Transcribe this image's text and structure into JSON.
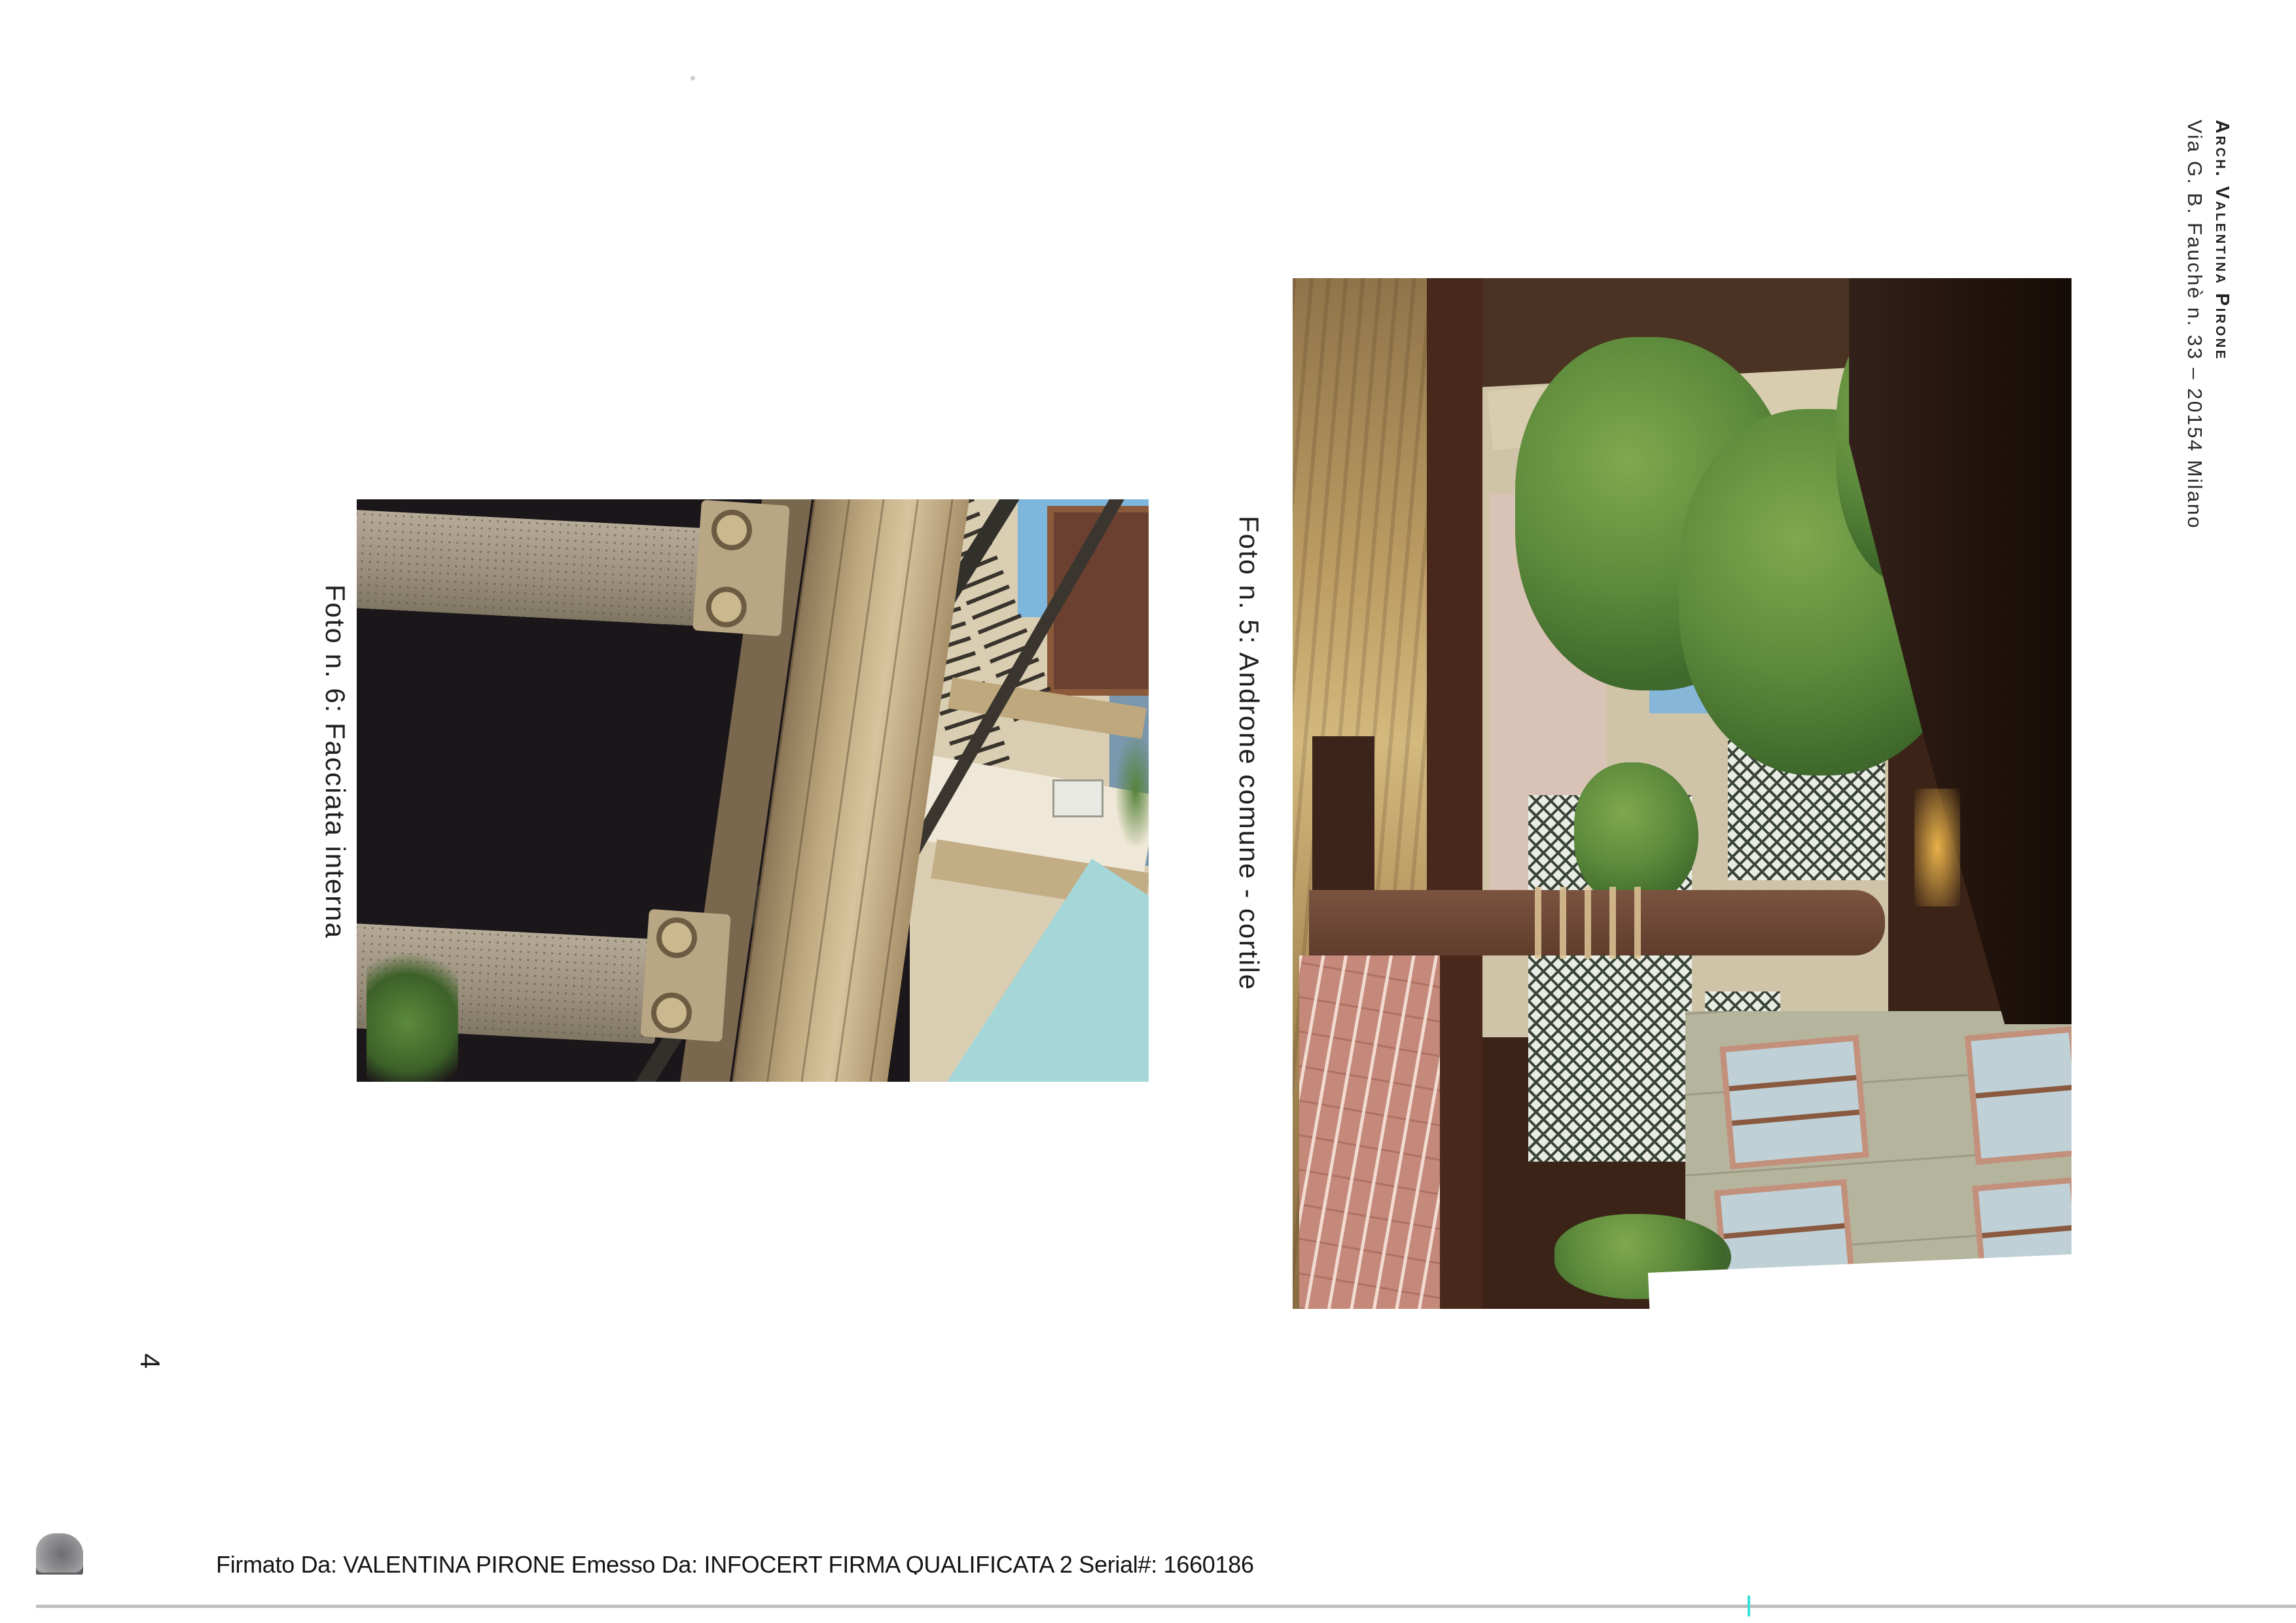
{
  "page": {
    "number": "4"
  },
  "header": {
    "line1": "Arch. Valentina Pirone",
    "line2": "Via G. B. Fauchè n. 33 – 20154 Milano"
  },
  "photos": [
    {
      "number": "5",
      "caption": "Foto n. 5: Androne comune - cortile"
    },
    {
      "number": "6",
      "caption": "Foto n. 6: Facciata interna"
    }
  ],
  "signature": {
    "text": "Firmato Da: VALENTINA PIRONE Emesso Da: INFOCERT FIRMA QUALIFICATA 2 Serial#: 1660186",
    "logo_icon": "infocert-seal-icon"
  },
  "colors": {
    "caption_text": "#1f1f1f",
    "header_text": "#222222",
    "bottom_rule": "#bcc0be",
    "seal_gray": "#8d8d90",
    "scan_artifact_cyan": "#39e0d8",
    "photo5_foliage_green": "#5d8a3c",
    "photo5_brick": "#c4897a",
    "photo6_sky_teal": "#a5d6d8",
    "photo6_stone_tan": "#bfa87e"
  }
}
